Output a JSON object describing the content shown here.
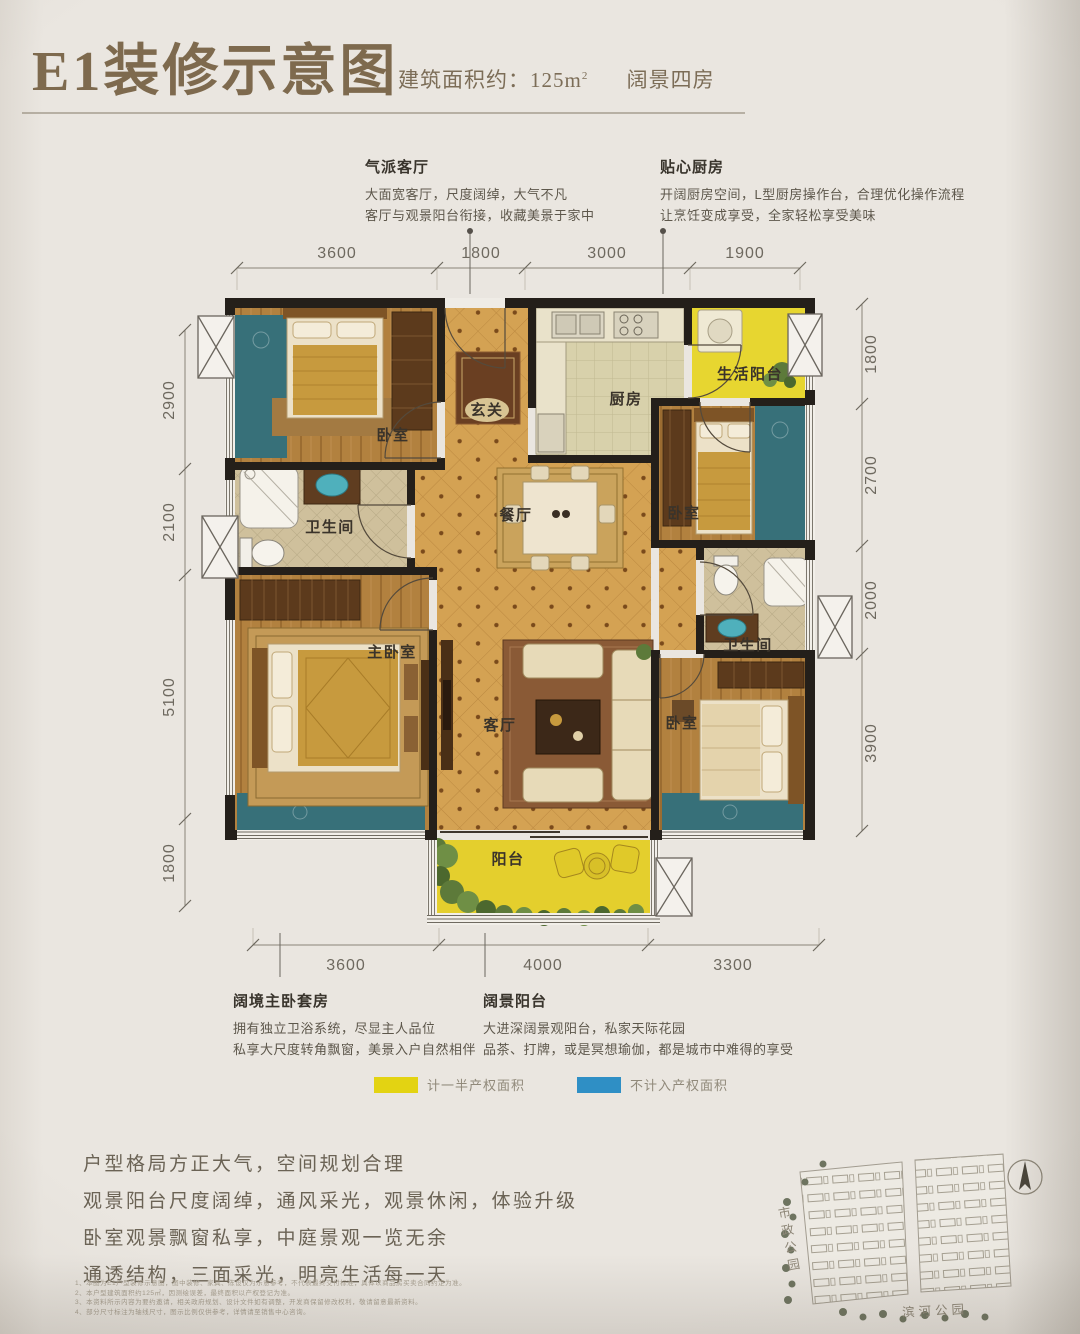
{
  "header": {
    "title": "E1装修示意图",
    "area_prefix": "建筑面积约：",
    "area_value": "125",
    "area_unit": "m",
    "area_sup": "2",
    "tag": "阔景四房"
  },
  "annotations": {
    "living": {
      "title": "气派客厅",
      "line1": "大面宽客厅，尺度阔绰，大气不凡",
      "line2": "客厅与观景阳台衔接，收藏美景于家中"
    },
    "kitchen": {
      "title": "贴心厨房",
      "line1": "开阔厨房空间，L型厨房操作台，合理优化操作流程",
      "line2": "让烹饪变成享受，全家轻松享受美味"
    },
    "master": {
      "title": "阔境主卧套房",
      "line1": "拥有独立卫浴系统，尽显主人品位",
      "line2": "私享大尺度转角飘窗，美景入户自然相伴"
    },
    "balcony": {
      "title": "阔景阳台",
      "line1": "大进深阔景观阳台，私家天际花园",
      "line2": "品茶、打牌，或是冥想瑜伽，都是城市中难得的享受"
    }
  },
  "rooms": {
    "bedroom_tl": "卧室",
    "entry": "玄关",
    "kitchen": "厨房",
    "service_balcony": "生活阳台",
    "bedroom_r": "卧室",
    "dining": "餐厅",
    "bath_l": "卫生间",
    "master": "主卧室",
    "bath_r": "卫生间",
    "living": "客厅",
    "bedroom_br": "卧室",
    "balcony": "阳台"
  },
  "dimensions": {
    "top": [
      "3600",
      "1800",
      "3000",
      "1900"
    ],
    "left": [
      "2900",
      "2100",
      "5100",
      "1800"
    ],
    "right": [
      "1800",
      "2700",
      "2000",
      "3900"
    ],
    "bottom": [
      "3600",
      "4000",
      "3300"
    ]
  },
  "legend": {
    "half_area": {
      "color": "#e3d312",
      "label": "计一半产权面积"
    },
    "excluded_area": {
      "color": "#2f8fc5",
      "label": "不计入产权面积"
    }
  },
  "features": [
    "户型格局方正大气，空间规划合理",
    "观景阳台尺度阔绰，通风采光，观景休闲，体验升级",
    "卧室观景飘窗私享，中庭景观一览无余",
    "通透结构，三面采光，明亮生活每一天"
  ],
  "minimap": {
    "park_left": "市政公园",
    "park_bottom": "滨河公园"
  },
  "disclaimer": [
    "1、本图为E1户型装修示意图，图中装修、家具、陈设仅为示意参考，不代表最终交付标准，具体以商品房买卖合同约定为准。",
    "2、本户型建筑面积约125㎡，因测绘误差，最终面积以产权登记为准。",
    "3、本资料所示内容为要约邀请，相关政府规划、设计文件如有调整，开发商保留修改权利，敬请留意最新资料。",
    "4、部分尺寸标注为轴线尺寸，图示比例仅供参考，详情请至销售中心咨询。"
  ]
}
